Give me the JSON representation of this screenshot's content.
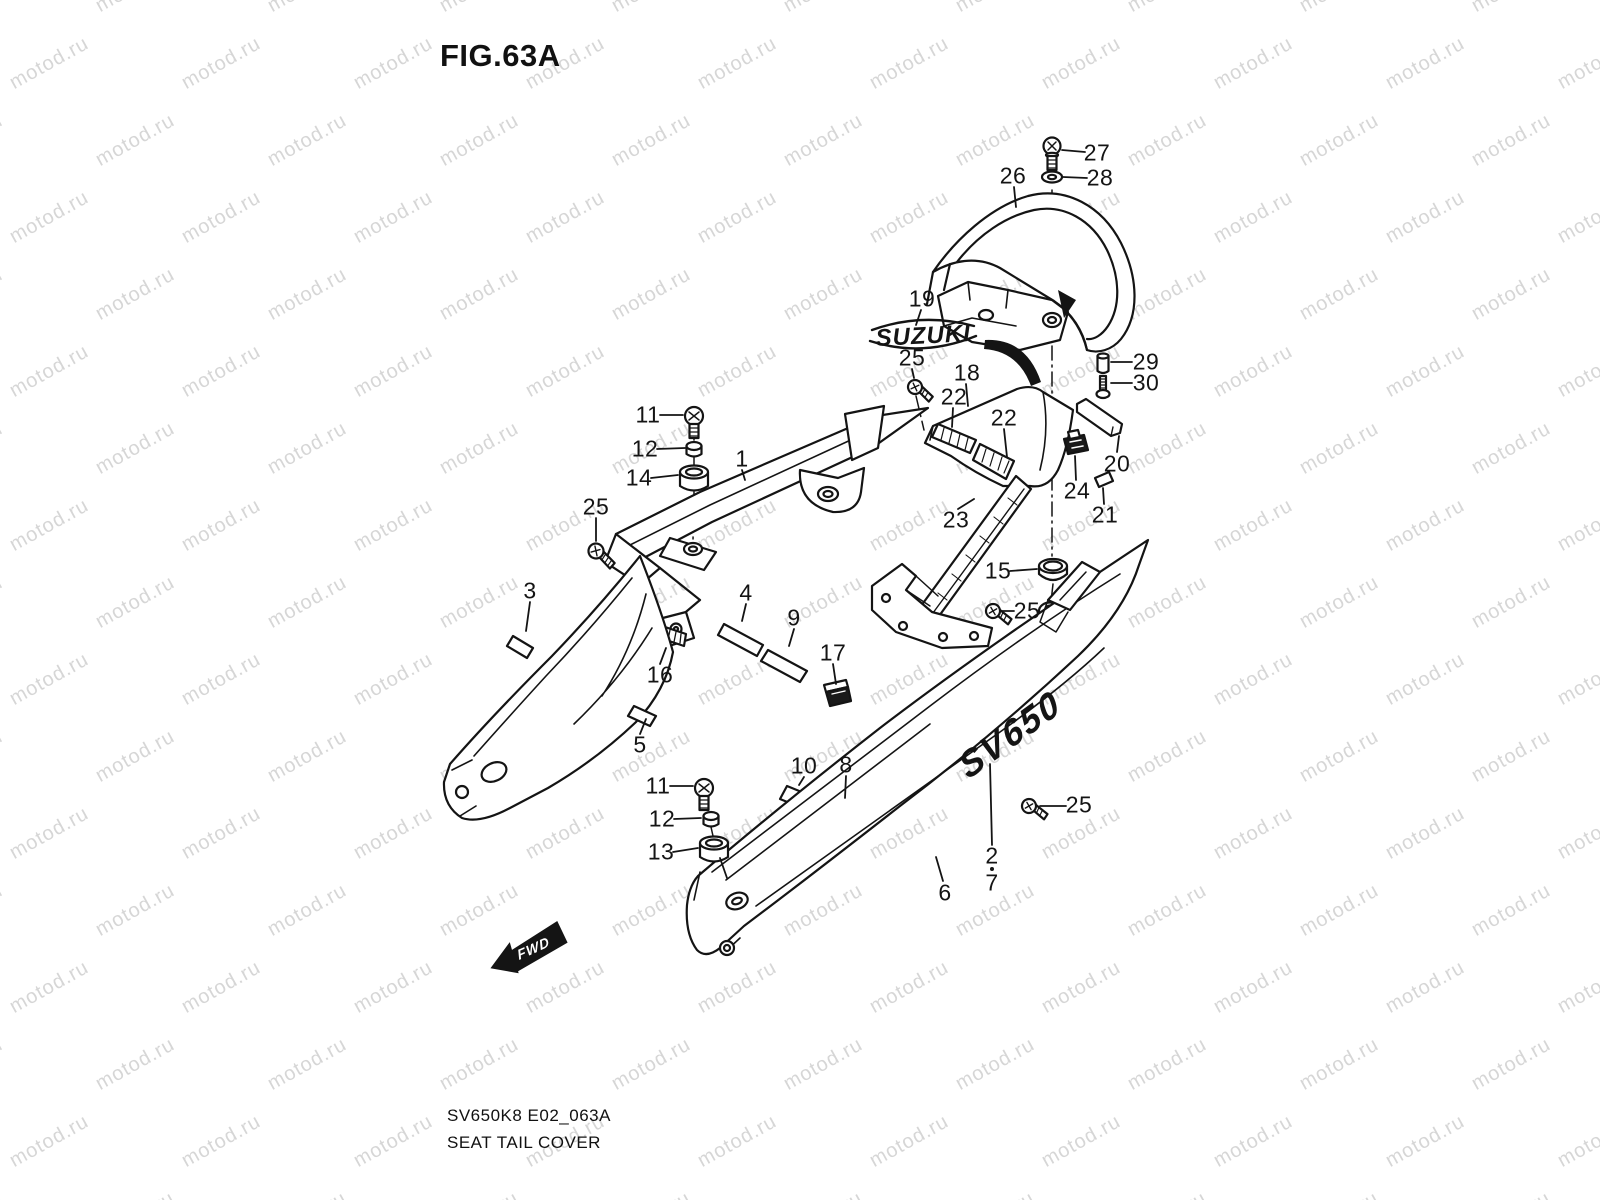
{
  "figure": {
    "title": "FIG.63A"
  },
  "doc": {
    "model_code": "SV650K8 E02_063A",
    "part_name": "SEAT TAIL COVER"
  },
  "watermark": {
    "text": "motod.ru",
    "color": "#d6d6d6"
  },
  "diagram": {
    "emblem_text": "SUZUKI",
    "side_logo_text": "SV650",
    "fwd_label": "FWD",
    "stroke_color": "#141414",
    "part_labels": [
      {
        "n": "1",
        "x": 742,
        "y": 459
      },
      {
        "n": "2",
        "x": 992,
        "y": 856
      },
      {
        "n": "3",
        "x": 530,
        "y": 591
      },
      {
        "n": "4",
        "x": 746,
        "y": 593
      },
      {
        "n": "5",
        "x": 640,
        "y": 745
      },
      {
        "n": "6",
        "x": 945,
        "y": 893
      },
      {
        "n": "7",
        "x": 992,
        "y": 883
      },
      {
        "n": "8",
        "x": 846,
        "y": 765
      },
      {
        "n": "9",
        "x": 794,
        "y": 618
      },
      {
        "n": "10",
        "x": 804,
        "y": 766
      },
      {
        "n": "11",
        "x": 648,
        "y": 415
      },
      {
        "n": "11",
        "x": 658,
        "y": 786
      },
      {
        "n": "12",
        "x": 645,
        "y": 449
      },
      {
        "n": "12",
        "x": 662,
        "y": 819
      },
      {
        "n": "13",
        "x": 661,
        "y": 852
      },
      {
        "n": "14",
        "x": 639,
        "y": 478
      },
      {
        "n": "15",
        "x": 998,
        "y": 571
      },
      {
        "n": "16",
        "x": 660,
        "y": 675
      },
      {
        "n": "17",
        "x": 833,
        "y": 653
      },
      {
        "n": "18",
        "x": 967,
        "y": 373
      },
      {
        "n": "19",
        "x": 922,
        "y": 299
      },
      {
        "n": "20",
        "x": 1117,
        "y": 464
      },
      {
        "n": "21",
        "x": 1105,
        "y": 515
      },
      {
        "n": "22",
        "x": 954,
        "y": 397
      },
      {
        "n": "22",
        "x": 1004,
        "y": 418
      },
      {
        "n": "23",
        "x": 956,
        "y": 520
      },
      {
        "n": "24",
        "x": 1077,
        "y": 491
      },
      {
        "n": "25",
        "x": 596,
        "y": 507
      },
      {
        "n": "25",
        "x": 912,
        "y": 358
      },
      {
        "n": "25",
        "x": 1027,
        "y": 611
      },
      {
        "n": "25",
        "x": 1079,
        "y": 805
      },
      {
        "n": "26",
        "x": 1013,
        "y": 176
      },
      {
        "n": "27",
        "x": 1097,
        "y": 153
      },
      {
        "n": "28",
        "x": 1100,
        "y": 178
      },
      {
        "n": "29",
        "x": 1146,
        "y": 362
      },
      {
        "n": "30",
        "x": 1146,
        "y": 383
      }
    ]
  }
}
